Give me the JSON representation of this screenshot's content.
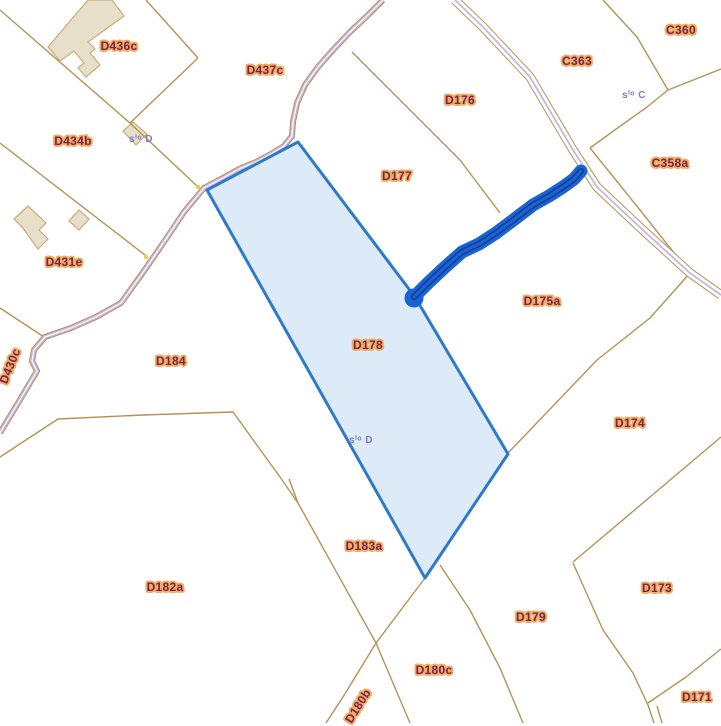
{
  "map": {
    "selected_parcel_id": "D178",
    "parcel_labels": {
      "d436c": "D436c",
      "d437c": "D437c",
      "d434b": "D434b",
      "d431e": "D431e",
      "d430c": "D430c",
      "c360": "C360",
      "c363": "C363",
      "c358a": "C358a",
      "d176": "D176",
      "d177": "D177",
      "d178": "D178",
      "d175a": "D175a",
      "d174": "D174",
      "d184": "D184",
      "d183a": "D183a",
      "d182a": "D182a",
      "d179": "D179",
      "d173": "D173",
      "d180c": "D180c",
      "d180b": "D180b",
      "d171": "D171"
    },
    "small_labels": {
      "house_d434b": "sⁱᵒ D",
      "house_c358a": "sⁱᵒ C",
      "house_d178": "sⁱᵒ D"
    },
    "colors": {
      "background": "#ffffff",
      "boundary_line": "#b59357",
      "road_fill": "#c6b5e6",
      "building_fill": "#e7dfca",
      "building_stroke": "#c9ad79",
      "parcel_highlight_fill": "#dcebf7",
      "parcel_highlight_stroke": "#2e7ac8",
      "selection_blue": "#1565d4",
      "selection_dark_blue": "#1e3d99",
      "label_text": "#7b2150",
      "label_halo": "#efae60",
      "small_label_text": "#8278bd"
    }
  }
}
